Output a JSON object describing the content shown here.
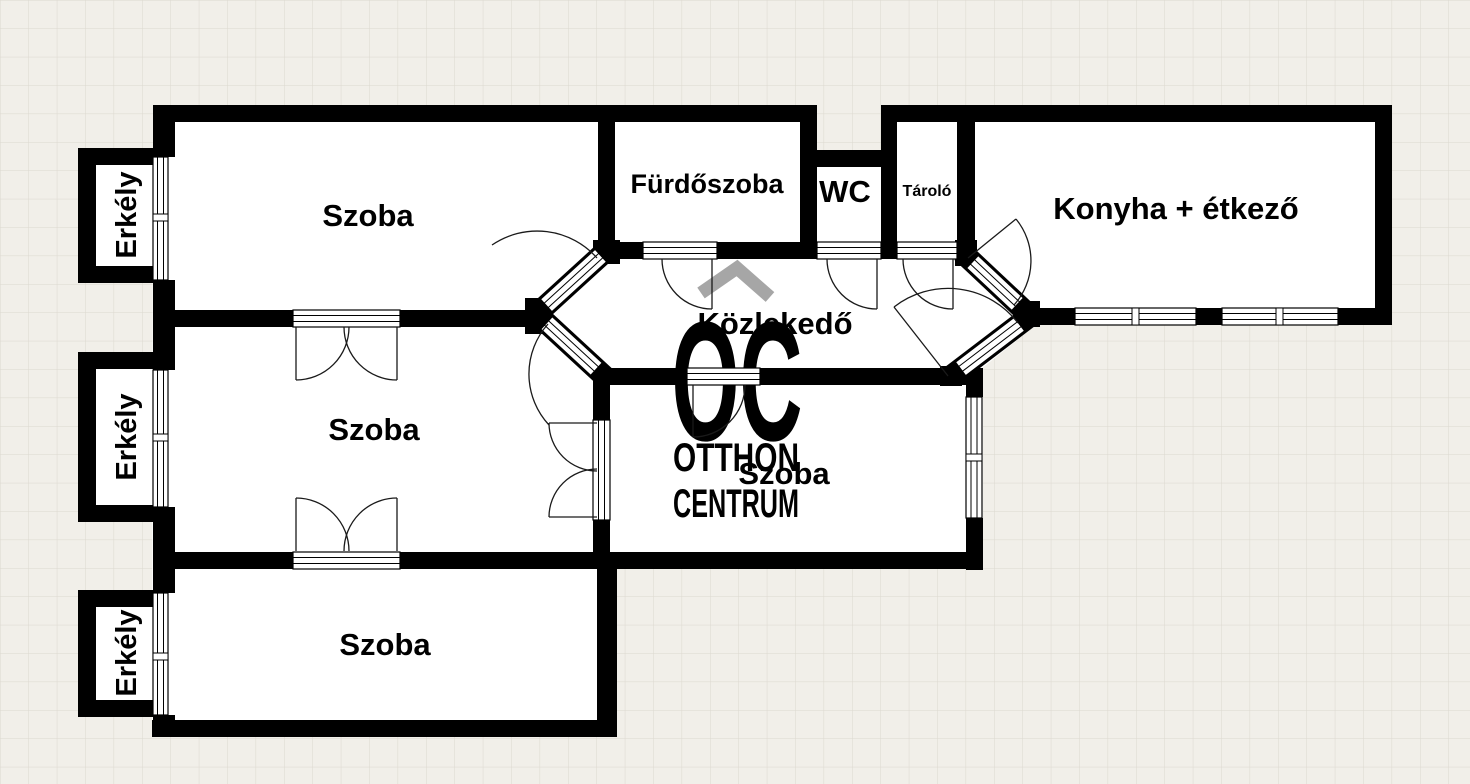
{
  "floorplan": {
    "rooms": {
      "room_top_left": {
        "label": "Szoba"
      },
      "bathroom": {
        "label": "Fürdőszoba"
      },
      "wc": {
        "label": "WC"
      },
      "storage": {
        "label": "Tároló"
      },
      "kitchen_dining": {
        "label": "Konyha + étkező"
      },
      "hallway": {
        "label": "Közlekedő"
      },
      "room_middle_left": {
        "label": "Szoba"
      },
      "room_middle_right": {
        "label": "Szoba"
      },
      "room_bottom_left": {
        "label": "Szoba"
      },
      "balcony_top": {
        "label": "Erkély"
      },
      "balcony_middle": {
        "label": "Erkély"
      },
      "balcony_bottom": {
        "label": "Erkély"
      }
    },
    "watermark": {
      "monogram": "OC",
      "line1": "OTTHON",
      "line2": "CENTRUM"
    },
    "colors": {
      "wall": "#000000",
      "background": "#f1efe9",
      "grid_line": "#dcd8cf",
      "room_fill": "#ffffff",
      "watermark_monogram": "#bdbdbd",
      "watermark_roof": "#a6a6a6",
      "watermark_text": "#c6c6c6"
    }
  }
}
